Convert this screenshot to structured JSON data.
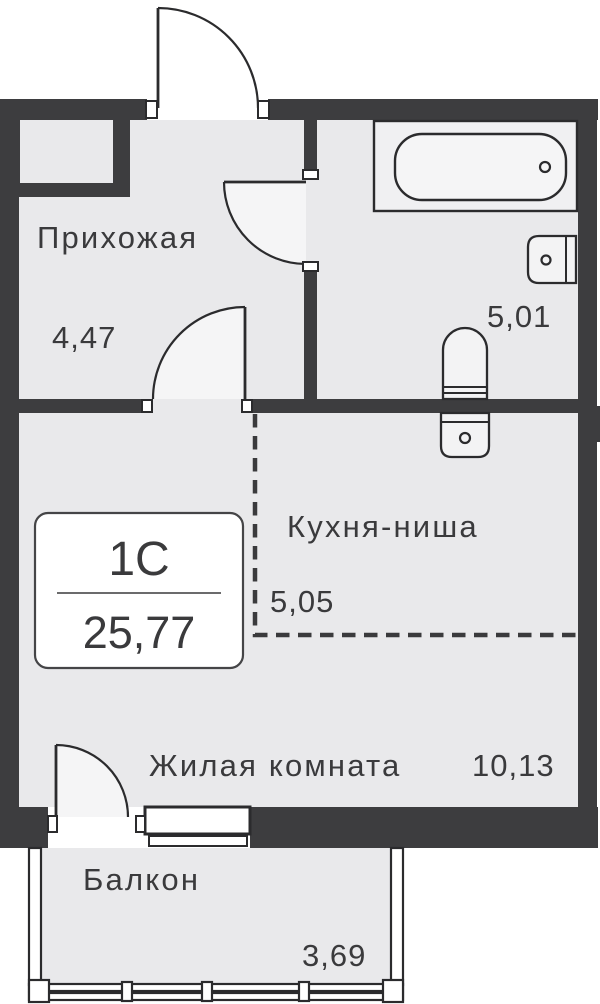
{
  "unit_card": {
    "type_label": "1С",
    "total_area": "25,77"
  },
  "rooms": [
    {
      "id": "hallway",
      "label": "Прихожая",
      "area": "4,47"
    },
    {
      "id": "bathroom",
      "label": "",
      "area": "5,01"
    },
    {
      "id": "kitchen-niche",
      "label": "Кухня-ниша",
      "area": "5,05"
    },
    {
      "id": "living-room",
      "label": "Жилая комната",
      "area": "10,13"
    },
    {
      "id": "balcony",
      "label": "Балкон",
      "area": "3,69"
    }
  ],
  "fixtures": [
    "bathtub",
    "bathroom-sink",
    "toilet",
    "kitchen-sink"
  ],
  "colors": {
    "wall": "#3d3d3f",
    "outline": "#2b2b2d",
    "floor": "#e9e9eb",
    "door_swing": "#f5f5f6",
    "background": "#ffffff",
    "text": "#3a3a3c"
  }
}
